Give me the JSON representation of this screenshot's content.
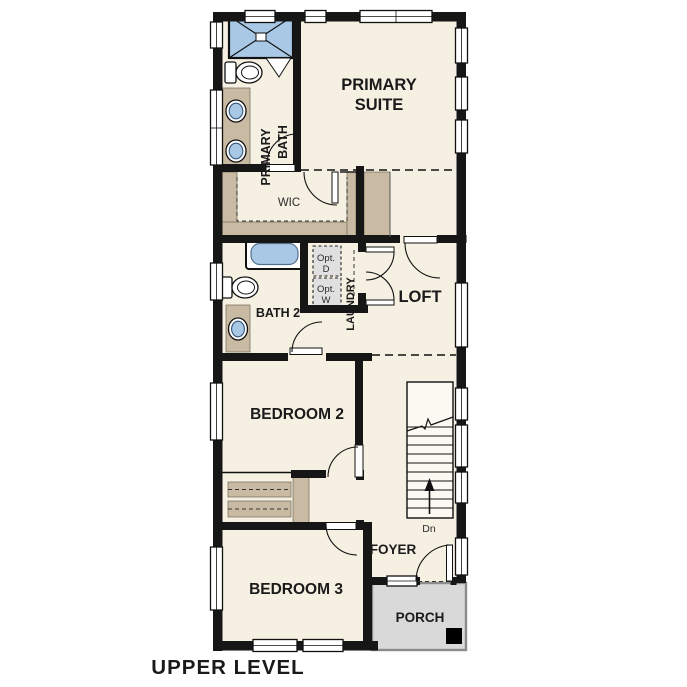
{
  "plan": {
    "title": "UPPER LEVEL",
    "rooms": {
      "primary_suite": {
        "line1": "PRIMARY",
        "line2": "SUITE"
      },
      "primary_bath": {
        "line1": "PRIMARY",
        "line2": "BATH"
      },
      "wic": "WIC",
      "laundry": "LAUNDRY",
      "opt_d": {
        "line1": "Opt.",
        "line2": "D"
      },
      "opt_w": {
        "line1": "Opt.",
        "line2": "W"
      },
      "loft": "LOFT",
      "bath_2": "BATH 2",
      "bedroom_2": "BEDROOM 2",
      "bedroom_3": "BEDROOM 3",
      "foyer": "FOYER",
      "porch": "PORCH",
      "stair_direction": "Dn"
    },
    "colors": {
      "background": "#ffffff",
      "floor": "#f6f0e2",
      "wall": "#161616",
      "cabinet": "#c9bba3",
      "fixture_blue": "#a9c8e5",
      "porch_fill": "#d9d9d9",
      "porch_edge": "#8c8c8c",
      "appliance_fill": "#e0e0e0",
      "stair_fill": "#fcf9f2",
      "window_white": "#ffffff",
      "label": "#1a1a1a"
    }
  }
}
